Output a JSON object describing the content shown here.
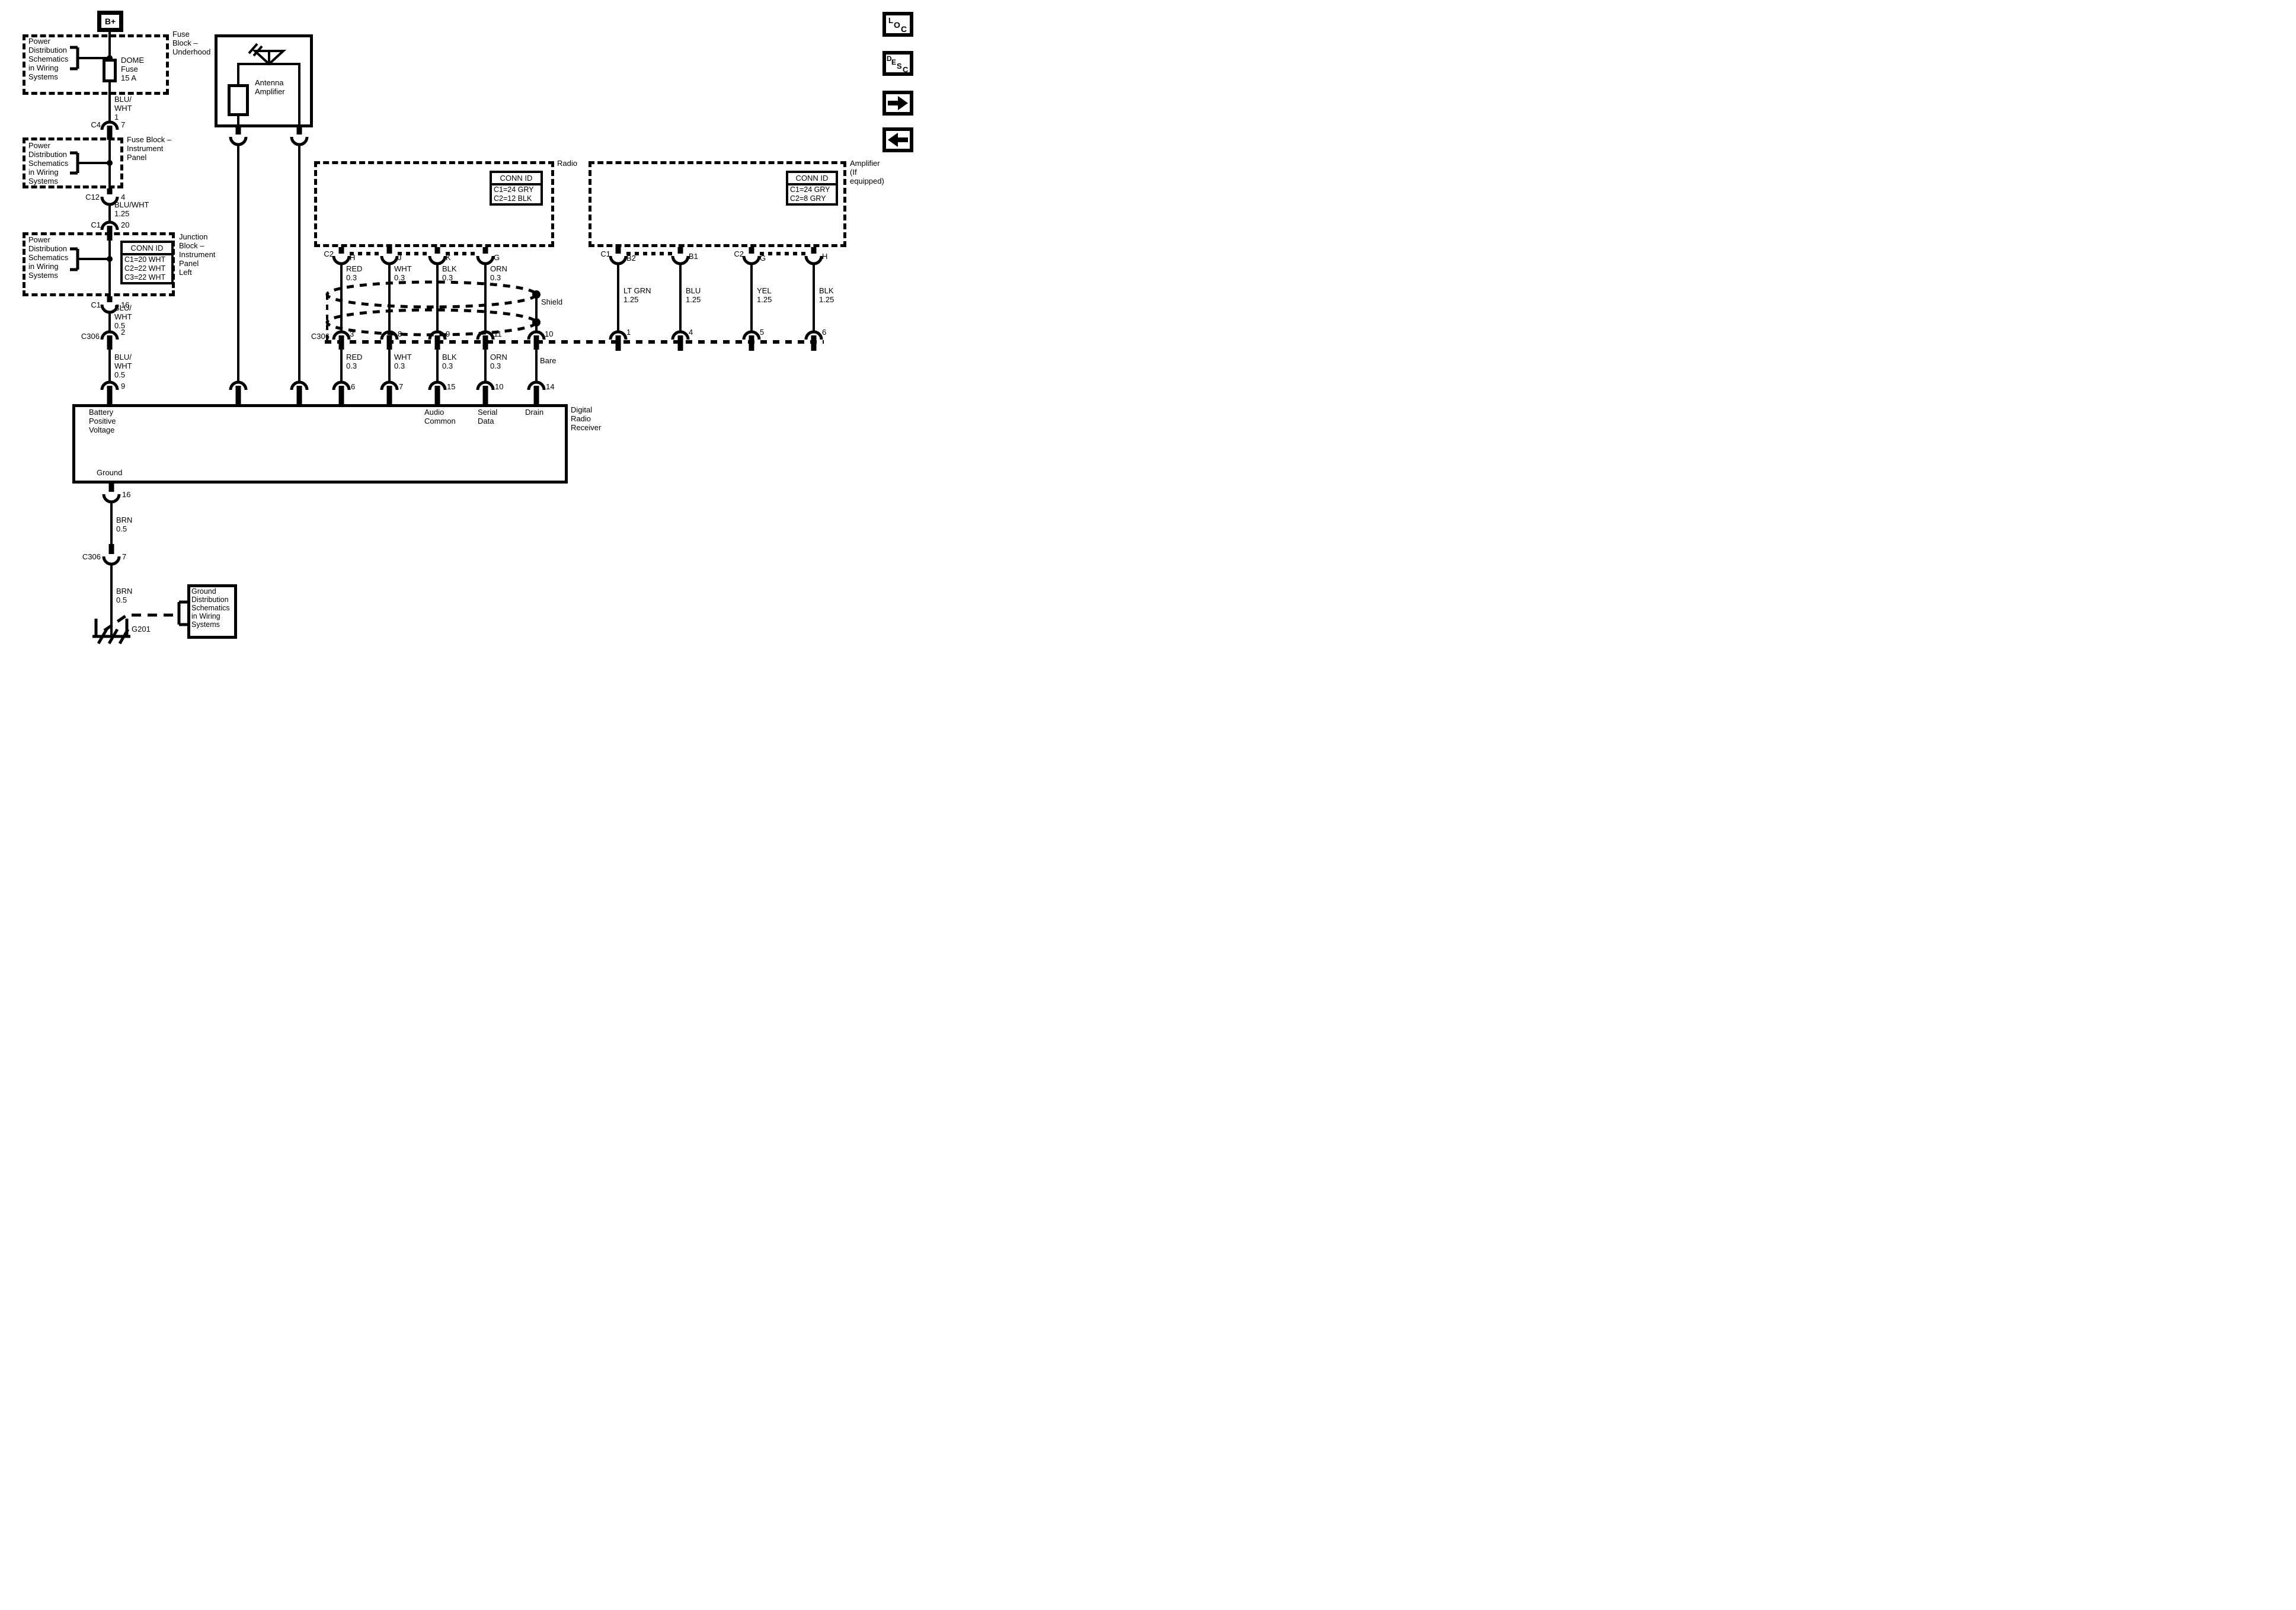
{
  "nav": {
    "loc_letters": [
      "L",
      "O",
      "C"
    ],
    "desc_letters": [
      "D",
      "E",
      "S",
      "C"
    ]
  },
  "power_feed": {
    "terminal": "B+",
    "ref_power_dist_1": "Power\nDistribution\nSchematics\nin Wiring\nSystems",
    "fuse_block_underhood_label": "Fuse\nBlock –\nUnderhood",
    "dome_fuse_label": "DOME\nFuse\n15 A",
    "wire_blu_wht_1": "BLU/\nWHT\n1",
    "c4": {
      "name": "C4",
      "pin": "7"
    },
    "ref_power_dist_2": "Power\nDistribution\nSchematics\nin Wiring\nSystems",
    "fuse_block_ip_label": "Fuse Block –\nInstrument\nPanel",
    "c12": {
      "name": "C12",
      "pin": "4"
    },
    "wire_blu_wht_125": "BLU/WHT\n1.25",
    "c1_in": {
      "name": "C1",
      "pin": "20"
    },
    "ref_power_dist_3": "Power\nDistribution\nSchematics\nin Wiring\nSystems",
    "junction_conn_id": {
      "title": "CONN ID",
      "rows": [
        "C1=20 WHT",
        "C2=22 WHT",
        "C3=22 WHT"
      ]
    },
    "junction_label": "Junction\nBlock –\nInstrument\nPanel\nLeft",
    "c1_out": {
      "name": "C1",
      "pin": "16"
    },
    "wire_blu_wht_05a": "BLU/\nWHT\n0.5",
    "c306_power": {
      "name": "C306",
      "pin": "2"
    },
    "wire_blu_wht_05b": "BLU/\nWHT\n0.5",
    "receiver_pin9": "9"
  },
  "antenna": {
    "label": "Antenna\nAmplifier"
  },
  "radio": {
    "label": "Radio",
    "conn_id": {
      "title": "CONN ID",
      "rows": [
        "C1=24 GRY",
        "C2=12 BLK"
      ]
    },
    "connector": "C2",
    "pins_top": [
      "H",
      "J",
      "K",
      "G"
    ],
    "wires_top": [
      "RED\n0.3",
      "WHT\n0.3",
      "BLK\n0.3",
      "ORN\n0.3"
    ],
    "shield_label": "Shield",
    "c306_name": "C306",
    "c306_pins": [
      "3",
      "8",
      "9",
      "11",
      "10"
    ],
    "wires_bottom": [
      "RED\n0.3",
      "WHT\n0.3",
      "BLK\n0.3",
      "ORN\n0.3",
      "Bare"
    ],
    "receiver_pins": [
      "6",
      "7",
      "15",
      "10",
      "14"
    ]
  },
  "amplifier": {
    "label": "Amplifier\n(If\nequipped)",
    "conn_id": {
      "title": "CONN ID",
      "rows": [
        "C1=24 GRY",
        "C2=8 GRY"
      ]
    },
    "connector1": "C1",
    "connector2": "C2",
    "pins_top": [
      "B2",
      "B1",
      "G",
      "H"
    ],
    "wires": [
      "LT GRN\n1.25",
      "BLU\n1.25",
      "YEL\n1.25",
      "BLK\n1.25"
    ],
    "pins_bottom": [
      "1",
      "4",
      "5",
      "6"
    ]
  },
  "receiver": {
    "label": "Digital\nRadio\nReceiver",
    "battery_label": "Battery\nPositive\nVoltage",
    "audio_label": "Audio\nCommon",
    "serial_label": "Serial\nData",
    "drain_label": "Drain",
    "ground_label": "Ground",
    "ground_pin": "16",
    "wire_brn_05a": "BRN\n0.5",
    "c306_ground": {
      "name": "C306",
      "pin": "7"
    },
    "wire_brn_05b": "BRN\n0.5",
    "ground_ref": "Ground\nDistribution\nSchematics\nin Wiring\nSystems",
    "ground_id": "G201"
  }
}
